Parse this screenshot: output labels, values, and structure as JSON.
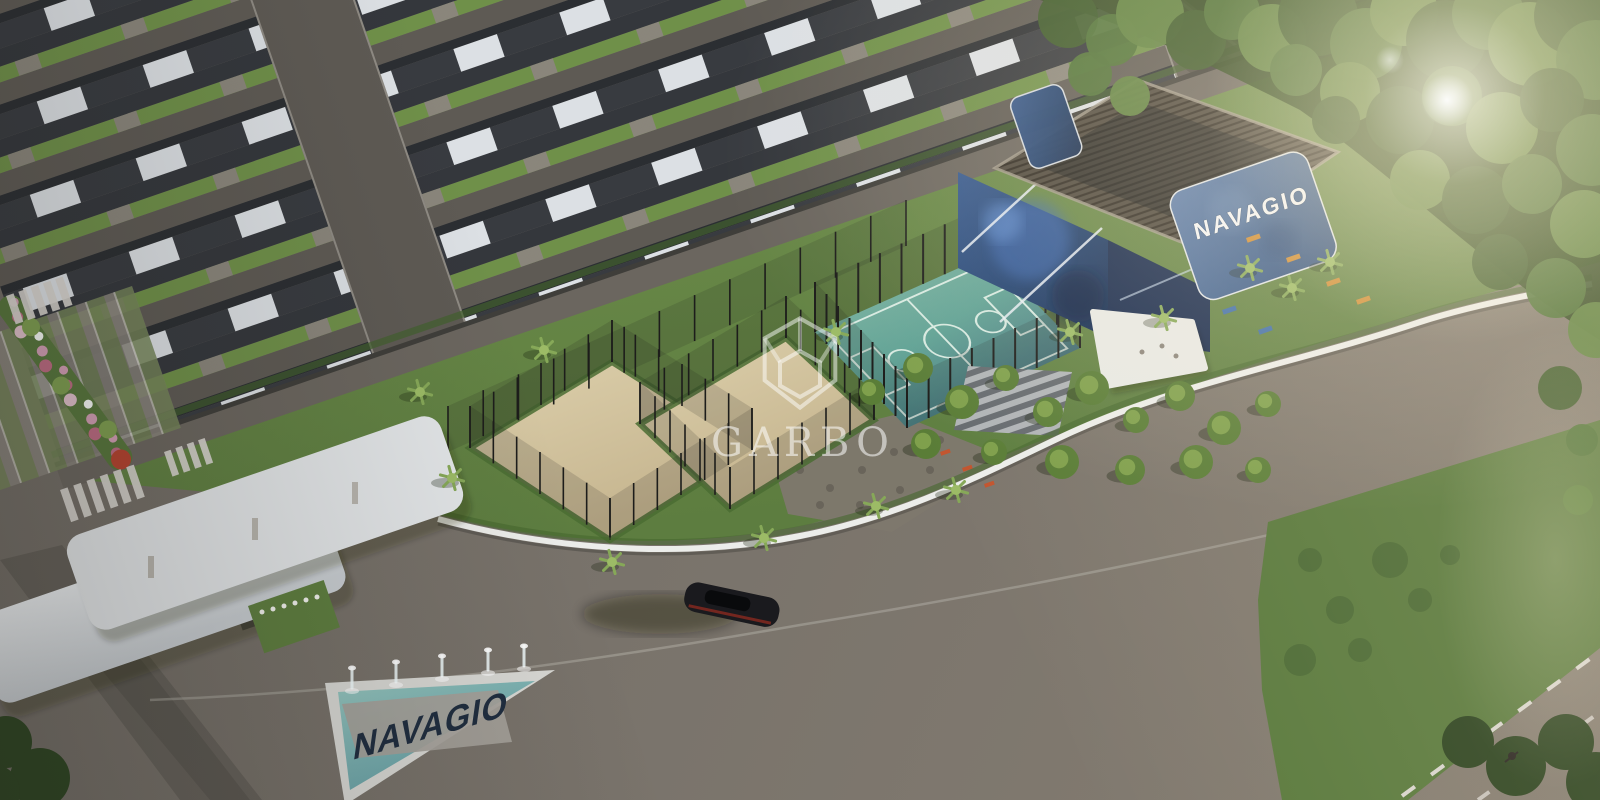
{
  "scene": {
    "name": "NAVAGIO condominium aerial render",
    "development_name": "NAVAGIO"
  },
  "branding": {
    "watermark_text": "GARBO",
    "watermark_logo": "gem-hexagon-icon"
  },
  "signs": {
    "clubhouse_panel_text": "NAVAGIO",
    "fountain_text": "NAVAGIO"
  },
  "palette": {
    "road_gray": "#6f6a63",
    "lawn_green": "#6d8d4a",
    "forest_green": "#3c5a2a",
    "court_teal": "#5ea396",
    "sand_beige": "#d5c6a3",
    "mural_blue": "#20406f",
    "panel_blue": "#40618f",
    "roof_dark": "#33363b",
    "roof_white": "#dce0e4",
    "fence_white": "#ecedea",
    "water_teal": "#7fb3ad",
    "flower_pink": "#d9a0ba",
    "accent_red": "#b5432f",
    "bench_orange": "#cf8c33"
  }
}
